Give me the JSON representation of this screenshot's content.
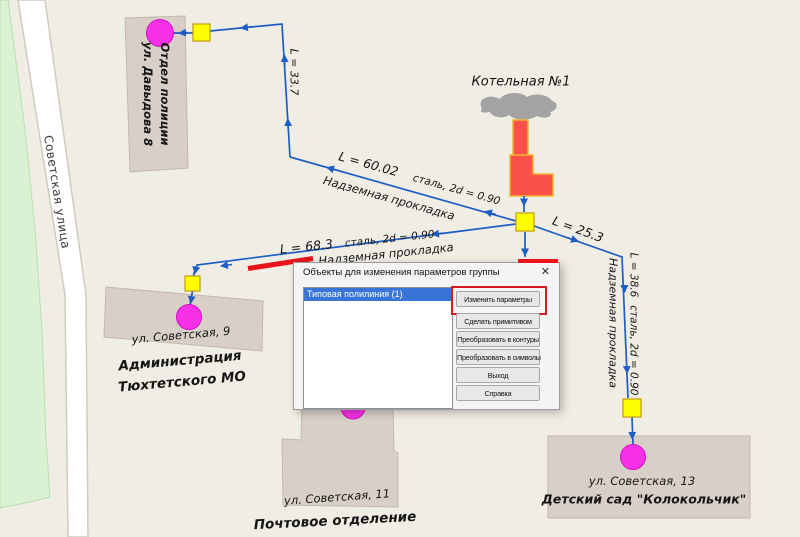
{
  "map": {
    "road_label": "Советская улица",
    "boiler_label": "Котельная №1",
    "buildings": {
      "police": {
        "name": "Отдел полиции",
        "address": "ул. Давыдова 8"
      },
      "admin": {
        "address": "ул. Советская, 9",
        "name_line1": "Администрация",
        "name_line2": "Тюхтетского МО"
      },
      "post_office": {
        "address": "ул. Советская, 11",
        "name": "Почтовое отделение"
      },
      "kindergarten": {
        "address": "ул. Советская, 13",
        "name": "Детский сад \"Колокольчик\""
      }
    },
    "pipes": {
      "p_police": {
        "length": "L = 33.7"
      },
      "p_main_west": {
        "length": "L = 60.02",
        "spec": "сталь, 2d = 0.90",
        "laying": "Надземная прокладка"
      },
      "p_admin": {
        "length": "L = 68.3",
        "spec": "сталь, 2d = 0.90",
        "laying": "Надземная прокладка"
      },
      "p_east": {
        "length": "L = 25.3"
      },
      "p_kindergarten": {
        "length": "L = 38.6",
        "spec": "сталь, 2d = 0.90",
        "laying": "Надземная прокладка"
      }
    },
    "colors": {
      "pipe_blue": "#1d5dc4",
      "node_square_yellow": "#ffff00",
      "node_circle_magenta": "#f831e8",
      "selection_red": "#e8131b",
      "boiler_red": "#fc5149"
    }
  },
  "dialog": {
    "title": "Объекты для изменения параметров группы",
    "close_glyph": "✕",
    "list_items": [
      {
        "label": "Типовая полилиния (1)",
        "selected": true
      }
    ],
    "buttons": [
      "Изменить параметры",
      "Сделать примитивом",
      "Преобразовать в контуры",
      "Преобразовать в символы",
      "Выход",
      "Справка"
    ]
  }
}
